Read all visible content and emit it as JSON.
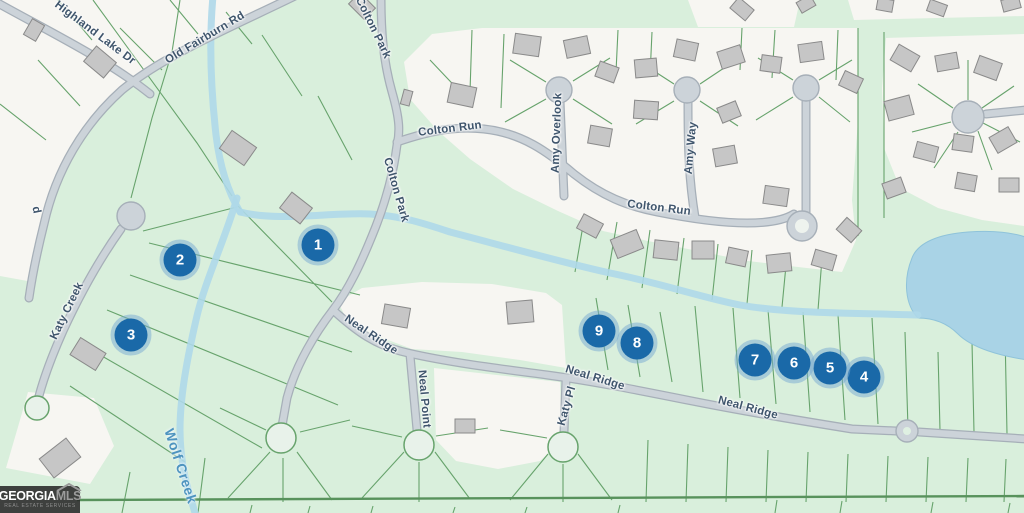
{
  "map": {
    "road_labels": [
      {
        "text": "Highland Lake Dr",
        "x": 95,
        "y": 33,
        "r": 37
      },
      {
        "text": "Old Fairburn Rd",
        "x": 205,
        "y": 38,
        "r": -31
      },
      {
        "text": "d",
        "x": 36,
        "y": 210,
        "r": 78
      },
      {
        "text": "Colton Park",
        "x": 373,
        "y": 28,
        "r": 64
      },
      {
        "text": "Colton Park",
        "x": 396,
        "y": 190,
        "r": 74
      },
      {
        "text": "Colton Run",
        "x": 450,
        "y": 129,
        "r": -7
      },
      {
        "text": "Colton Run",
        "x": 659,
        "y": 208,
        "r": 7
      },
      {
        "text": "Amy Overlook",
        "x": 557,
        "y": 133,
        "r": -88
      },
      {
        "text": "Amy Way",
        "x": 691,
        "y": 148,
        "r": -85
      },
      {
        "text": "Katy Creek",
        "x": 67,
        "y": 311,
        "r": -64
      },
      {
        "text": "Neal Ridge",
        "x": 371,
        "y": 335,
        "r": 34
      },
      {
        "text": "Neal Ridge",
        "x": 595,
        "y": 378,
        "r": 17
      },
      {
        "text": "Neal Ridge",
        "x": 748,
        "y": 408,
        "r": 15
      },
      {
        "text": "Neal Point",
        "x": 424,
        "y": 399,
        "r": 85
      },
      {
        "text": "Katy Pl",
        "x": 567,
        "y": 406,
        "r": -74
      }
    ],
    "water_labels": [
      {
        "text": "Wolf Creek",
        "x": 181,
        "y": 466,
        "r": 72
      }
    ],
    "markers": [
      {
        "label": "1",
        "x": 318,
        "y": 245
      },
      {
        "label": "2",
        "x": 180,
        "y": 260
      },
      {
        "label": "3",
        "x": 131,
        "y": 335
      },
      {
        "label": "4",
        "x": 864,
        "y": 377
      },
      {
        "label": "5",
        "x": 830,
        "y": 368
      },
      {
        "label": "6",
        "x": 794,
        "y": 363
      },
      {
        "label": "7",
        "x": 755,
        "y": 360
      },
      {
        "label": "8",
        "x": 637,
        "y": 343
      },
      {
        "label": "9",
        "x": 599,
        "y": 331
      }
    ]
  },
  "logo": {
    "primary": "GEORGIA",
    "secondary": "MLS",
    "tagline": "REAL ESTATE SERVICES"
  },
  "colors": {
    "parcel_green": "#d9efdc",
    "parcel_white": "#f7f6f2",
    "boundary_line": "#67a36c",
    "road_fill": "#ccd3d9",
    "road_casing": "#a6afb8",
    "road_label_color": "#3f556c",
    "water_blue": "#aed8e9",
    "pond_blue": "#a9d3e6",
    "marker_blue": "#1a69a8",
    "marker_halo": "rgba(120,170,210,0.5)",
    "building_fill": "#c6c6c6",
    "building_stroke": "#8a8a8a",
    "water_label_color": "#4e94bf"
  }
}
